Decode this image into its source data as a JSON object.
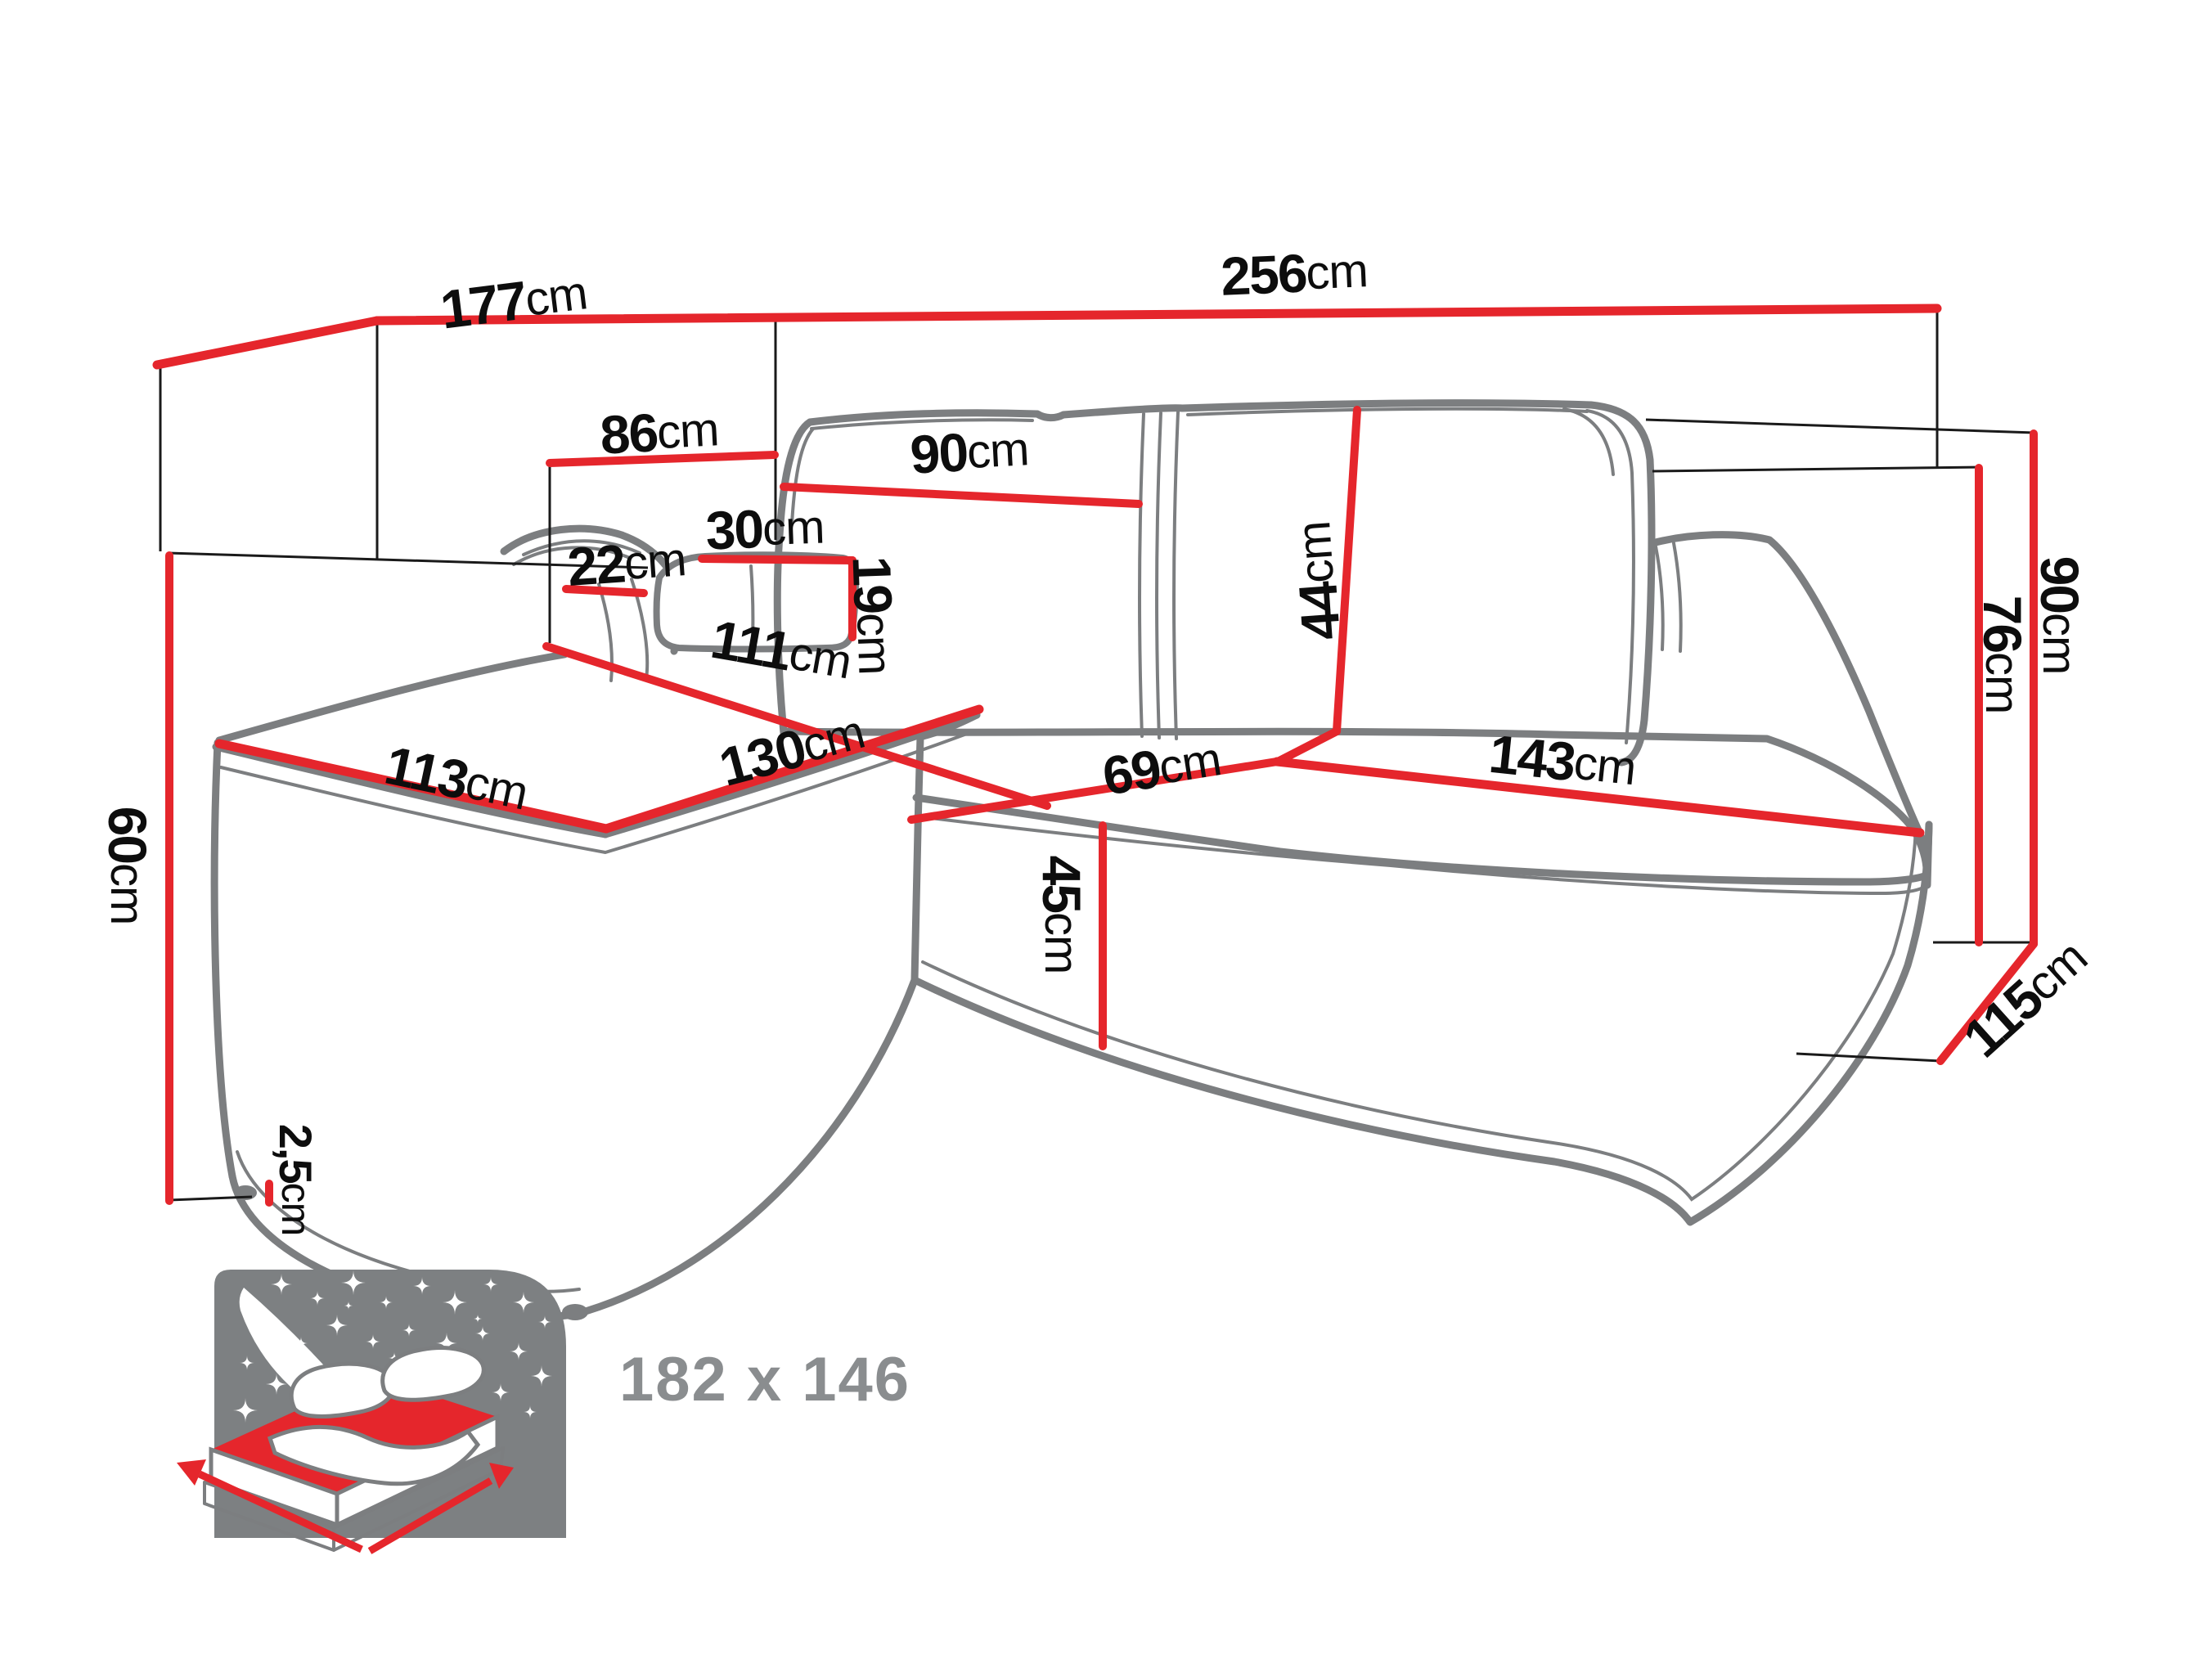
{
  "figure": {
    "type": "corner-sofa dimension diagram",
    "style": "gray line-art sofa with red dimension lines and black measurement labels"
  },
  "colors": {
    "dimension_red": "#e5262c",
    "outline_gray": "#7c7e80",
    "label_black": "#0d0d0d",
    "sleeping_text_gray": "#8a8d8f",
    "background": "#ffffff"
  },
  "dims": {
    "d177": {
      "v": "177",
      "u": "cm"
    },
    "d256": {
      "v": "256",
      "u": "cm"
    },
    "d86": {
      "v": "86",
      "u": "cm"
    },
    "d90back": {
      "v": "90",
      "u": "cm"
    },
    "d30": {
      "v": "30",
      "u": "cm"
    },
    "d22": {
      "v": "22",
      "u": "cm"
    },
    "d19": {
      "v": "19",
      "u": "cm"
    },
    "d44": {
      "v": "44",
      "u": "cm"
    },
    "d111": {
      "v": "111",
      "u": "cm"
    },
    "d113": {
      "v": "113",
      "u": "cm"
    },
    "d130": {
      "v": "130",
      "u": "cm"
    },
    "d69": {
      "v": "69",
      "u": "cm"
    },
    "d143": {
      "v": "143",
      "u": "cm"
    },
    "d45": {
      "v": "45",
      "u": "cm"
    },
    "d60": {
      "v": "60",
      "u": "cm"
    },
    "d25": {
      "v": "2,5",
      "u": "cm"
    },
    "d76": {
      "v": "76",
      "u": "cm"
    },
    "d90h": {
      "v": "90",
      "u": "cm"
    },
    "d115": {
      "v": "115",
      "u": "cm"
    }
  },
  "sleeping": {
    "label": "182 x 146"
  },
  "icon": {
    "name": "sleeping-function-icon",
    "stars": [
      [
        302,
        1592,
        9
      ],
      [
        344,
        1570,
        13
      ],
      [
        388,
        1587,
        9
      ],
      [
        432,
        1568,
        15
      ],
      [
        472,
        1592,
        8
      ],
      [
        516,
        1572,
        11
      ],
      [
        556,
        1592,
        15
      ],
      [
        600,
        1570,
        9
      ],
      [
        640,
        1592,
        13
      ],
      [
        666,
        1616,
        8
      ],
      [
        322,
        1624,
        11
      ],
      [
        368,
        1642,
        8
      ],
      [
        412,
        1620,
        13
      ],
      [
        456,
        1640,
        9
      ],
      [
        500,
        1626,
        8
      ],
      [
        546,
        1642,
        13
      ],
      [
        590,
        1630,
        9
      ],
      [
        634,
        1652,
        11
      ],
      [
        662,
        1682,
        13
      ],
      [
        302,
        1666,
        9
      ],
      [
        338,
        1692,
        13
      ],
      [
        300,
        1724,
        15
      ],
      [
        332,
        1756,
        8
      ],
      [
        562,
        1672,
        8
      ],
      [
        612,
        1702,
        11
      ],
      [
        648,
        1726,
        8
      ],
      [
        522,
        1692,
        7
      ],
      [
        482,
        1660,
        7
      ],
      [
        426,
        1596,
        5
      ],
      [
        584,
        1612,
        5
      ]
    ]
  }
}
